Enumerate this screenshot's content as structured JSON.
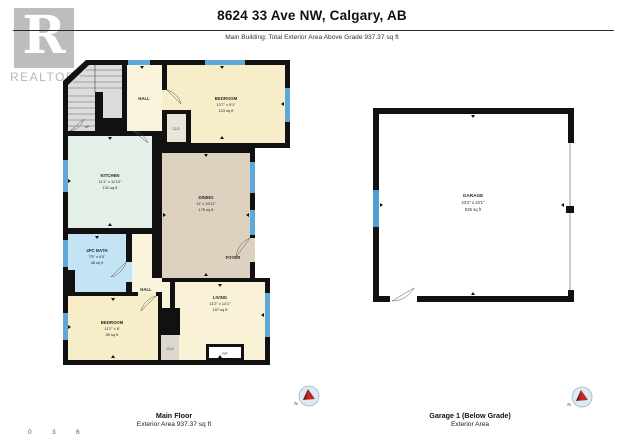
{
  "header": {
    "title": "8624 33 Ave NW, Calgary, AB",
    "subtitle": "Main Building: Total Exterior Area Above Grade 937.37 sq ft"
  },
  "logo": {
    "letter": "R",
    "word": "REALTOR",
    "registered": "®"
  },
  "main_floor": {
    "stairs_label": "UP",
    "hall_top": "HALL",
    "hall_bottom": "HALL",
    "foyer": "FOYER",
    "closet_top": "CLO",
    "closet_bottom": "CLO",
    "fireplace": "F/P",
    "bedroom_top": {
      "name": "BEDROOM",
      "dims": "13'7\" x 9'1\"",
      "area": "123 sq ft"
    },
    "kitchen": {
      "name": "KITCHEN",
      "dims": "11'1\" x 11'10\"",
      "area": "131 sq ft"
    },
    "dining": {
      "name": "DINING",
      "dims": "11' x 15'11\"",
      "area": "175 sq ft"
    },
    "bath": {
      "name": "4PC BATH",
      "dims": "7'5\" x 6'5\"",
      "area": "48 sq ft"
    },
    "bedroom_bottom": {
      "name": "BEDROOM",
      "dims": "11'2\" x 8'",
      "area": "89 sq ft"
    },
    "living": {
      "name": "LIVING",
      "dims": "11'2\" x 14'1\"",
      "area": "157 sq ft"
    },
    "caption": {
      "title": "Main Floor",
      "subtitle": "Exterior Area 937.37 sq ft"
    }
  },
  "garage": {
    "room": {
      "name": "GARAGE",
      "dims": "23'2\" x 23'1\"",
      "area": "535 sq ft"
    },
    "caption": {
      "title": "Garage 1 (Below Grade)",
      "subtitle": "Exterior Area"
    }
  },
  "compass": {
    "north_label": "N"
  },
  "footer": {
    "scale_ticks": [
      "0",
      "3",
      "6"
    ]
  },
  "colors": {
    "wall": "#111111",
    "window": "#5fa7d7",
    "bedroom_fill": "#f8edc9",
    "hall_fill": "#faf4dc",
    "kitchen_fill": "#e4efe7",
    "dining_fill": "#dcd2bf",
    "bath_fill": "#c4e4f6",
    "stairs_fill": "#dcdcdc",
    "compass_needle": "#c3271d"
  }
}
